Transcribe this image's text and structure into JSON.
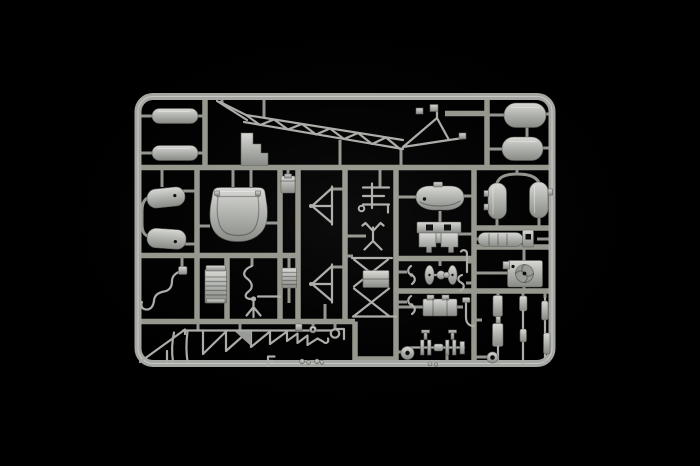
{
  "scene": {
    "type": "product-photo",
    "subject": "Injection-molded grey plastic model kit sprue (parts tree) with unassembled helicopter parts on a black background",
    "text_visible": "none"
  },
  "colors": {
    "background": "#000000",
    "frame": "#a6a8a3",
    "runner": "#97998f",
    "plastic_light": "#dadbd7",
    "plastic_mid": "#b3b5b1",
    "plastic_shadow": "#85877f"
  },
  "parts": {
    "frame": {
      "name": "sprue outer frame (rounded rectangle)"
    },
    "runners": {
      "name": "sprue runner grid and gate stubs"
    },
    "tank_small_upper": {
      "name": "small capsule tank, top-left upper"
    },
    "tank_small_lower": {
      "name": "small capsule tank, top-left lower"
    },
    "step_block": {
      "name": "stepped console block"
    },
    "tail_boom": {
      "name": "lattice tail boom truss with tail rotor mount"
    },
    "float_upper": {
      "name": "large float pontoon, top-right upper"
    },
    "float_lower": {
      "name": "large float pontoon, top-right lower"
    },
    "side_tank_upper": {
      "name": "side fuel tank, mid-left upper"
    },
    "side_tank_lower": {
      "name": "side fuel tank, mid-left lower"
    },
    "canopy": {
      "name": "bubble cabin canopy"
    },
    "access_box": {
      "name": "small access panel box"
    },
    "brace_frame_upper": {
      "name": "triangular brace frame, upper"
    },
    "brace_frame_lower": {
      "name": "triangular brace frame, lower"
    },
    "ladder_frame": {
      "name": "ladder-style control frame"
    },
    "linkage_cross": {
      "name": "four-arm control linkage"
    },
    "engine_mount_truss": {
      "name": "X-braced engine mount truss"
    },
    "cowling": {
      "name": "rounded engine cowling shell"
    },
    "seat_panel": {
      "name": "seat / bulkhead panel with cutouts"
    },
    "wheels_axle": {
      "name": "ground-handling wheels on axle"
    },
    "rotor_blades_upper": {
      "name": "small twin-blade rotor, upper"
    },
    "rotor_blades_lower": {
      "name": "small twin-blade rotor, lower"
    },
    "engine_block": {
      "name": "engine block"
    },
    "elbow_pipe": {
      "name": "elbow pipe"
    },
    "stick_pipe": {
      "name": "hooked pipe"
    },
    "curve_pipe": {
      "name": "S-curved pipe"
    },
    "pontoon_left": {
      "name": "vertical tank, right column left"
    },
    "pontoon_right": {
      "name": "vertical tank, right column right"
    },
    "muffler": {
      "name": "muffler cylinder with end bracket"
    },
    "fan_unit": {
      "name": "engine cooling fan unit"
    },
    "radiator": {
      "name": "ribbed radiator core"
    },
    "fuel_line": {
      "name": "coiled fuel line with fork fitting"
    },
    "ribbed_panel": {
      "name": "small ribbed panel"
    },
    "exhaust_pipe": {
      "name": "curved exhaust pipe"
    },
    "antenna_mast": {
      "name": "triangular mast with whip antennas"
    },
    "sawtooth_antenna": {
      "name": "saw-tooth antenna strip"
    },
    "bottom_fittings": {
      "name": "small fittings on bottom rail"
    },
    "rotor_hub": {
      "name": "rotor hub drive shaft assembly"
    },
    "strut_left": {
      "name": "shock strut, left"
    },
    "strut_mid": {
      "name": "shock strut, middle"
    },
    "strut_right": {
      "name": "shock strut, right"
    },
    "grommet": {
      "name": "grommet ring"
    }
  }
}
